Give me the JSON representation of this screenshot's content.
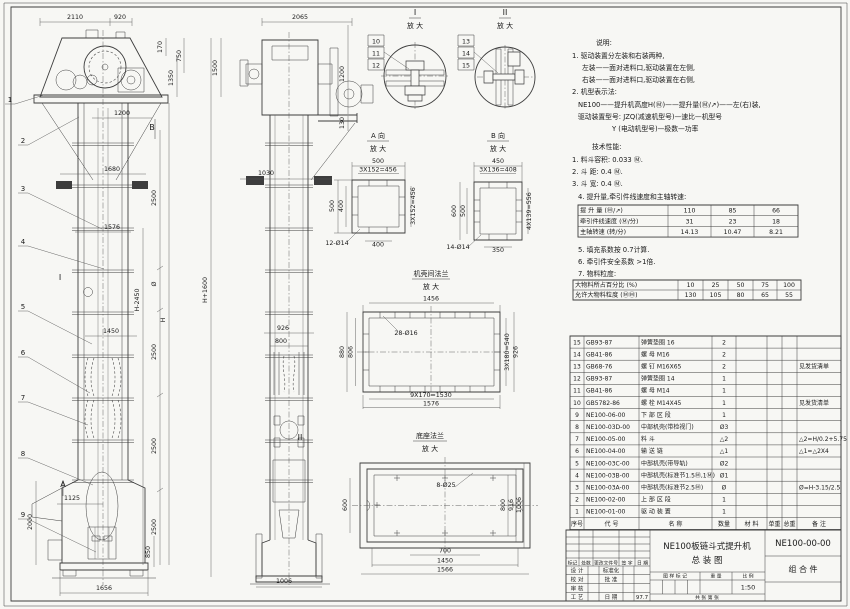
{
  "notes": {
    "lines": [
      {
        "x": 596,
        "y": 45,
        "t": "说明:"
      },
      {
        "x": 572,
        "y": 58,
        "t": "1. 驱动装置分左装和右装两种,"
      },
      {
        "x": 582,
        "y": 70,
        "t": "左装——面对进料口,驱动装置在左侧,"
      },
      {
        "x": 582,
        "y": 82,
        "t": "右装——面对进料口,驱动装置在右侧,"
      },
      {
        "x": 572,
        "y": 94,
        "t": "2. 机型表示法:"
      },
      {
        "x": 578,
        "y": 107,
        "t": "NE100——提升机高度H(Ⓜ)——提升量(Ⓜ/↗)——左(右)装,"
      },
      {
        "x": 578,
        "y": 119,
        "t": "驱动装置型号: JZQ(减速机型号)—速比—机型号"
      },
      {
        "x": 612,
        "y": 131,
        "t": "Y (电动机型号)—极数—功率"
      },
      {
        "x": 592,
        "y": 149,
        "t": "技术性能:"
      },
      {
        "x": 572,
        "y": 162,
        "t": "1. 料斗容积: 0.033 Ⓜ."
      },
      {
        "x": 572,
        "y": 174,
        "t": "2. 斗    距: 0.4 Ⓜ."
      },
      {
        "x": 572,
        "y": 186,
        "t": "3. 斗    宽: 0.4 Ⓜ."
      },
      {
        "x": 578,
        "y": 199,
        "t": "4. 提升量,牵引件线速度和主轴转速:"
      },
      {
        "x": 578,
        "y": 252,
        "t": "5. 填充系数按 0.7计算."
      },
      {
        "x": 578,
        "y": 264,
        "t": "6. 牵引件安全系数 >1倍."
      },
      {
        "x": 578,
        "y": 276,
        "t": "7. 物料粒度:"
      }
    ]
  },
  "tables": {
    "capacity": {
      "x": 578,
      "y": 205,
      "cols": [
        90,
        43,
        43,
        44
      ],
      "rowH": 10.7,
      "fs": 6.2,
      "align": [
        "l",
        "c",
        "c",
        "c"
      ],
      "rows": [
        [
          "提 升 量  (Ⓜ/↗)",
          "110",
          "85",
          "66"
        ],
        [
          "牵引件线速度 (Ⓜ/分)",
          "31",
          "23",
          "18"
        ],
        [
          "主轴转速  (转/分)",
          "14.13",
          "10.47",
          "8.21"
        ]
      ]
    },
    "particle": {
      "x": 573,
      "y": 280,
      "cols": [
        105,
        25,
        25,
        25,
        24,
        24
      ],
      "rowH": 10,
      "fs": 6.2,
      "align": [
        "l",
        "c",
        "c",
        "c",
        "c",
        "c"
      ],
      "rows": [
        [
          "大物料所占百分比 (%)",
          "10",
          "25",
          "50",
          "75",
          "100"
        ],
        [
          "允许大物料粒度 (ⓂⓂ)",
          "130",
          "105",
          "80",
          "65",
          "55"
        ]
      ]
    },
    "bom": {
      "x": 570,
      "y": 336,
      "cols": [
        14,
        55,
        73,
        24,
        31,
        15,
        15,
        44
      ],
      "rowH": 12.1,
      "fs": 6,
      "align": [
        "c",
        "l",
        "l",
        "c",
        "c",
        "c",
        "c",
        "l"
      ],
      "rows": [
        [
          "15",
          "GB93-87",
          "弹簧垫圈 16",
          "2",
          "",
          "",
          "",
          ""
        ],
        [
          "14",
          "GB41-86",
          "螺 母  M16",
          "2",
          "",
          "",
          "",
          ""
        ],
        [
          "13",
          "GB68-76",
          "螺 钉  M16X65",
          "2",
          "",
          "",
          "",
          "见发货清单"
        ],
        [
          "12",
          "GB93-87",
          "弹簧垫圈 14",
          "1",
          "",
          "",
          "",
          ""
        ],
        [
          "11",
          "GB41-86",
          "螺 母  M14",
          "1",
          "",
          "",
          "",
          ""
        ],
        [
          "10",
          "GB5782-86",
          "螺 栓  M14X45",
          "1",
          "",
          "",
          "",
          "见发货清单"
        ],
        [
          "9",
          "NE100-06-00",
          "下 部 区 段",
          "1",
          "",
          "",
          "",
          ""
        ],
        [
          "8",
          "NE100-03D-00",
          "中部机壳(带检视门)",
          "Ø3",
          "",
          "",
          "",
          ""
        ],
        [
          "7",
          "NE100-05-00",
          "料 斗",
          "△2",
          "",
          "",
          "",
          "△2=H/0.2+5.75"
        ],
        [
          "6",
          "NE100-04-00",
          "输 送 链",
          "△1",
          "",
          "",
          "",
          "△1=△2X4"
        ],
        [
          "5",
          "NE100-03C-00",
          "中部机壳(带导轨)",
          "Ø2",
          "",
          "",
          "",
          ""
        ],
        [
          "4",
          "NE100-03B-00",
          "中部机壳(标准节1.5Ⓜ,1Ⓜ)",
          "Ø1",
          "",
          "",
          "",
          ""
        ],
        [
          "3",
          "NE100-03A-00",
          "中部机壳(标准节2.5Ⓜ)",
          "Ø",
          "",
          "",
          "",
          "Ø=H-3.15/2.5"
        ],
        [
          "2",
          "NE100-02-00",
          "上 部 区 段",
          "1",
          "",
          "",
          "",
          ""
        ],
        [
          "1",
          "NE100-01-00",
          "驱 动 装 置",
          "1",
          "",
          "",
          "",
          ""
        ]
      ],
      "header": [
        "序号",
        "代  号",
        "名  称",
        "数量",
        "材  料",
        "单重",
        "总重",
        "备 注"
      ]
    }
  },
  "title_block": {
    "title1": "NE100板链斗式提升机",
    "title2": "总  装  图",
    "drawing_no": "NE100-00-00",
    "part_type": "组 合 件",
    "scale": "1:50",
    "date": "97.7",
    "cells": [
      {
        "t": "标记",
        "x": 572.5,
        "y": 564.5,
        "s": 4.8
      },
      {
        "t": "处数",
        "x": 586,
        "y": 564.5,
        "s": 4.8
      },
      {
        "t": "更改文件号",
        "x": 606,
        "y": 564.5,
        "s": 4.8
      },
      {
        "t": "签 字",
        "x": 627,
        "y": 564.5,
        "s": 4.8
      },
      {
        "t": "日 期",
        "x": 642.5,
        "y": 564.5,
        "s": 4.8
      },
      {
        "t": "设 计",
        "x": 577,
        "y": 572.5,
        "s": 5.5
      },
      {
        "t": "标准化",
        "x": 611,
        "y": 572.5,
        "s": 5.5
      },
      {
        "t": "校 对",
        "x": 577,
        "y": 581.5,
        "s": 5.5
      },
      {
        "t": "批 准",
        "x": 611,
        "y": 581.5,
        "s": 5.5
      },
      {
        "t": "审 核",
        "x": 577,
        "y": 590.5,
        "s": 5.5
      },
      {
        "t": "工 艺",
        "x": 577,
        "y": 599,
        "s": 5.5
      },
      {
        "t": "日 期",
        "x": 611,
        "y": 599,
        "s": 5.5
      },
      {
        "t": "97.7",
        "x": 642,
        "y": 599,
        "s": 5.5
      },
      {
        "t": "图 样 标 记",
        "x": 675,
        "y": 577.5,
        "s": 4.8
      },
      {
        "t": "重 量",
        "x": 716,
        "y": 577.5,
        "s": 4.8
      },
      {
        "t": "比 例",
        "x": 748,
        "y": 577.5,
        "s": 4.8
      },
      {
        "t": "1:50",
        "x": 748,
        "y": 589.5,
        "s": 6.5
      },
      {
        "t": "共    张    第    张",
        "x": 707,
        "y": 599,
        "s": 4.8
      }
    ]
  },
  "details": {
    "d1": {
      "label": "I",
      "sub": "放 大"
    },
    "d2": {
      "label": "II",
      "sub": "放 大"
    },
    "a": {
      "label": "A 向",
      "sub": "放 大"
    },
    "b": {
      "label": "B 向",
      "sub": "放 大"
    },
    "flange": {
      "label": "机壳间法兰",
      "sub": "放 大"
    },
    "base": {
      "label": "底座法兰",
      "sub": "放 大"
    }
  },
  "dims": [
    [
      "2110",
      75,
      19,
      0
    ],
    [
      "920",
      120,
      19,
      0
    ],
    [
      "170",
      162,
      47,
      1
    ],
    [
      "750",
      181,
      56,
      1
    ],
    [
      "1350",
      173,
      78,
      1
    ],
    [
      "1500",
      217,
      68,
      1
    ],
    [
      "1200",
      122,
      115,
      0
    ],
    [
      "1680",
      112,
      171,
      0
    ],
    [
      "1576",
      112,
      229,
      0
    ],
    [
      "2500",
      156,
      198,
      1
    ],
    [
      "Ø",
      156,
      284,
      1
    ],
    [
      "2500",
      156,
      352,
      1
    ],
    [
      "2500",
      156,
      446,
      1
    ],
    [
      "2500",
      156,
      527,
      1
    ],
    [
      "H-2450",
      139,
      300,
      1
    ],
    [
      "H",
      165,
      320,
      1
    ],
    [
      "H+1600",
      207,
      290,
      1
    ],
    [
      "1450",
      111,
      333,
      0
    ],
    [
      "1125",
      72,
      500,
      0
    ],
    [
      "2000",
      32,
      522,
      1
    ],
    [
      "850",
      150,
      552,
      1
    ],
    [
      "1656",
      104,
      590,
      0
    ],
    [
      "2065",
      300,
      19,
      0
    ],
    [
      "1200",
      344,
      74,
      1
    ],
    [
      "130",
      344,
      123,
      1
    ],
    [
      "1030",
      266,
      175,
      0
    ],
    [
      "926",
      283,
      330,
      0
    ],
    [
      "800",
      281,
      343,
      0
    ],
    [
      "1006",
      284,
      583,
      0
    ],
    [
      "500",
      378,
      163,
      0
    ],
    [
      "3X152=456",
      378,
      171.5,
      0
    ],
    [
      "500",
      334,
      206,
      1
    ],
    [
      "400",
      343,
      206,
      1
    ],
    [
      "3X152=456",
      415,
      206,
      1
    ],
    [
      "400",
      378,
      246.5,
      0
    ],
    [
      "12-Ø14",
      337,
      245,
      0
    ],
    [
      "450",
      498,
      163,
      0
    ],
    [
      "3X136=408",
      498,
      171.5,
      0
    ],
    [
      "600",
      456,
      211,
      1
    ],
    [
      "500",
      465,
      211,
      1
    ],
    [
      "4X139=556",
      531,
      211,
      1
    ],
    [
      "350",
      498,
      252,
      0
    ],
    [
      "14-Ø14",
      458,
      249,
      0
    ],
    [
      "1456",
      431,
      300.5,
      0
    ],
    [
      "28-Ø16",
      406,
      335,
      0
    ],
    [
      "880",
      344,
      352,
      1
    ],
    [
      "806",
      352.5,
      352,
      1
    ],
    [
      "3X180=540",
      509,
      352,
      1
    ],
    [
      "926",
      517.5,
      352,
      1
    ],
    [
      "9X170=1530",
      431,
      397,
      0
    ],
    [
      "1576",
      431,
      405.5,
      0
    ],
    [
      "8-Ø25",
      446,
      487,
      0
    ],
    [
      "600",
      347,
      505,
      1
    ],
    [
      "800",
      505,
      505,
      1
    ],
    [
      "916",
      513,
      505,
      1
    ],
    [
      "1006",
      521,
      505,
      1
    ],
    [
      "700",
      445,
      552.5,
      0
    ],
    [
      "1450",
      445,
      562.5,
      0
    ],
    [
      "1566",
      445,
      571.5,
      0
    ]
  ],
  "markers": [
    [
      "B",
      152,
      130
    ],
    [
      "A",
      63,
      487
    ],
    [
      "I",
      60,
      280
    ],
    [
      "II",
      300,
      440
    ]
  ],
  "balloons": [
    [
      "1",
      10,
      102,
      44,
      95
    ],
    [
      "2",
      23,
      143,
      79,
      117
    ],
    [
      "3",
      23,
      191,
      102,
      229
    ],
    [
      "4",
      23,
      244,
      104,
      269
    ],
    [
      "5",
      23,
      309,
      92,
      344
    ],
    [
      "6",
      23,
      355,
      90,
      393
    ],
    [
      "7",
      23,
      400,
      88,
      425
    ],
    [
      "8",
      23,
      456,
      93,
      485
    ],
    [
      "9",
      23,
      517,
      96,
      552
    ]
  ],
  "callouts": {
    "left": {
      "x": 368,
      "y": 35,
      "items": [
        "10",
        "11",
        "12"
      ],
      "lx": 384,
      "ly": 52,
      "tx": 409,
      "ty": 69
    },
    "right": {
      "x": 458,
      "y": 35,
      "items": [
        "13",
        "14",
        "15"
      ],
      "lx": 474,
      "ly": 52,
      "tx": 498,
      "ty": 73
    }
  }
}
